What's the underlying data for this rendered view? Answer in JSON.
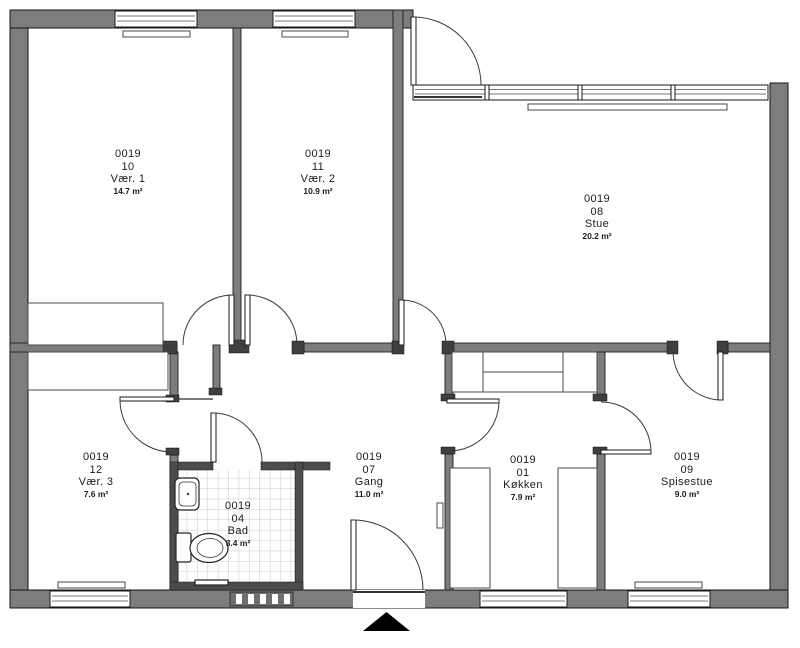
{
  "rooms": [
    {
      "id": "0019",
      "number": "10",
      "name": "Vær. 1",
      "area": "14.7 m²"
    },
    {
      "id": "0019",
      "number": "11",
      "name": "Vær. 2",
      "area": "10.9 m²"
    },
    {
      "id": "0019",
      "number": "08",
      "name": "Stue",
      "area": "20.2 m²"
    },
    {
      "id": "0019",
      "number": "12",
      "name": "Vær. 3",
      "area": "7.6 m²"
    },
    {
      "id": "0019",
      "number": "04",
      "name": "Bad",
      "area": "3.4 m²"
    },
    {
      "id": "0019",
      "number": "07",
      "name": "Gang",
      "area": "11.0 m²"
    },
    {
      "id": "0019",
      "number": "01",
      "name": "Køkken",
      "area": "7.9 m²"
    },
    {
      "id": "0019",
      "number": "09",
      "name": "Spisestue",
      "area": "9.0 m²"
    }
  ],
  "colors": {
    "exterior_wall": "#7d7d7d",
    "interior_wall": "#7d7d7d",
    "bathroom_wall": "#4c4c4c",
    "wall_cap": "#3f3f3f",
    "tile_line": "#c8c8c8",
    "entrance_marker": "#000000",
    "background": "#ffffff"
  },
  "icons": {
    "entrance_arrow": "solid black triangle pointing up at main entrance",
    "toilet": "toilet plan symbol",
    "sink": "hand basin plan symbol"
  }
}
